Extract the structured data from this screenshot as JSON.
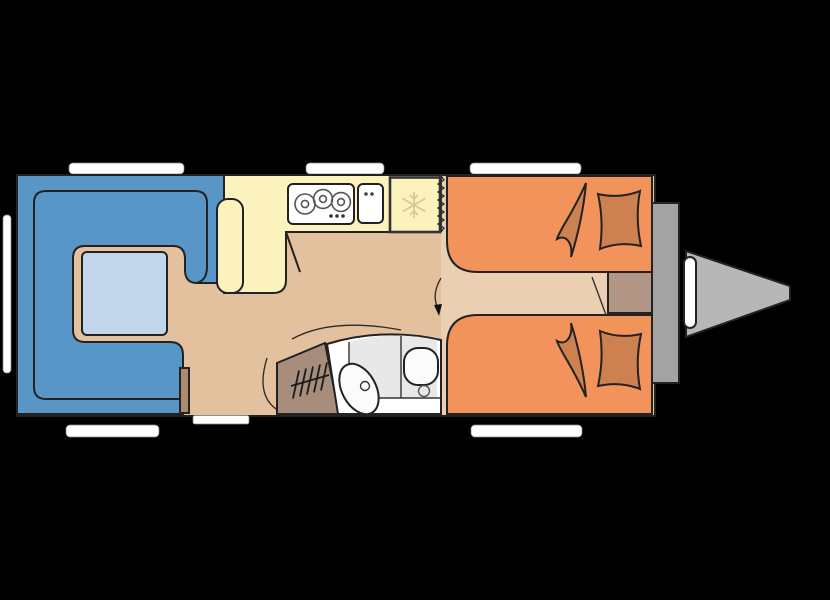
{
  "image": {
    "kind": "caravan-floorplan",
    "view": "top-down",
    "visible_text": ""
  },
  "colors": {
    "background": "#000000",
    "outline": "#222222",
    "floor": "#E3C09E",
    "floor_bedroom": "#EACFB3",
    "sofa": "#5896C7",
    "table": "#C2D6EB",
    "kitchen": "#FBF2BE",
    "appliance": "#FFFFFE",
    "bed": "#F2935B",
    "bedding": "#CD8150",
    "wardrobe": "#A78D7B",
    "cabinet": "#B29786",
    "heater": "#AD8A70",
    "bath_floor": "#E8E8E8",
    "bath_fixture": "#FBFBFB",
    "wall": "#A3A3A3",
    "hitch": "#B7B7B7",
    "window": "#FFFFFF",
    "step": "#FFFFFF",
    "snowflake": "#D9C893",
    "arrow": "#111111"
  },
  "rooms": [
    {
      "id": "lounge",
      "name": "u-shaped-lounge-with-table"
    },
    {
      "id": "kitchen",
      "name": "kitchen-galley"
    },
    {
      "id": "bathroom",
      "name": "washroom-with-basin-and-toilet"
    },
    {
      "id": "wardrobe",
      "name": "wardrobe"
    },
    {
      "id": "bedroom",
      "name": "twin-single-beds"
    }
  ],
  "features": [
    {
      "name": "hob",
      "burners": 3
    },
    {
      "name": "kitchen-sink",
      "taps": 2
    },
    {
      "name": "refrigerator",
      "icon": "snowflake-icon"
    },
    {
      "name": "dinette-table"
    },
    {
      "name": "seat-cushion"
    },
    {
      "name": "wardrobe-hangers",
      "hanger_marks": 5
    },
    {
      "name": "washbasin"
    },
    {
      "name": "toilet"
    },
    {
      "name": "beds",
      "count": 2,
      "pillows": 2,
      "duvets": 2
    },
    {
      "name": "bedside-cabinet"
    },
    {
      "name": "front-storage-wall"
    },
    {
      "name": "a-frame-hitch"
    },
    {
      "name": "windows",
      "count": 6
    },
    {
      "name": "entry-step"
    },
    {
      "name": "concertina-partition"
    }
  ]
}
